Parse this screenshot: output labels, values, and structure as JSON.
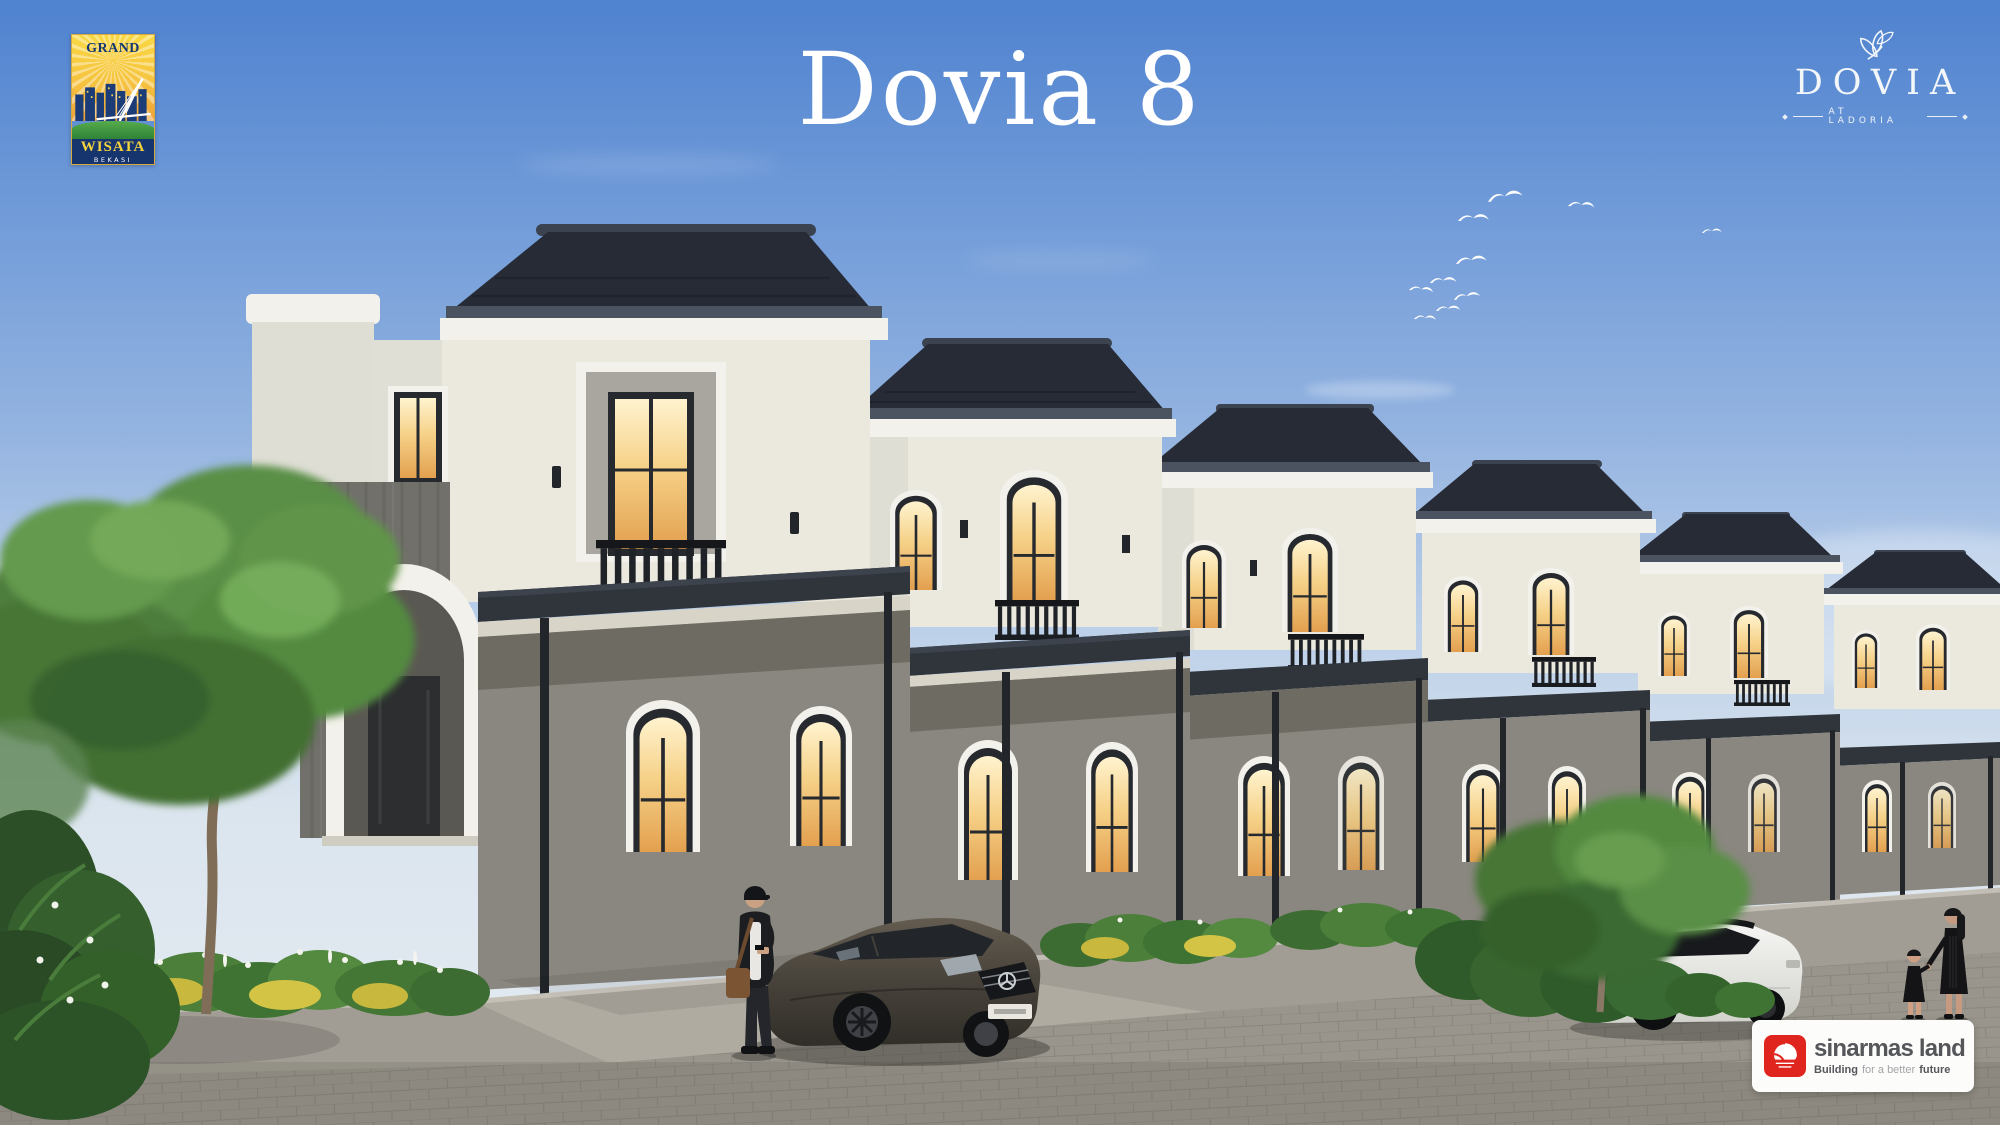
{
  "page": {
    "width": 2000,
    "height": 1125,
    "description": "Architectural launch visual of Dovia 8 two-storey houses at Ladoria, Grand Wisata Bekasi"
  },
  "grand_wisata_logo": {
    "top": "GRAND",
    "middle": "WISATA",
    "bottom": "BEKASI"
  },
  "title": {
    "text": "Dovia 8"
  },
  "dovia_logo": {
    "name": "DOVIA",
    "tagline": "AT LADORIA"
  },
  "sinarmas_logo": {
    "brand": "sinarmas land",
    "tagline_bold_start": "Building",
    "tagline_light": "for a better",
    "tagline_bold_end": "future"
  },
  "colors": {
    "sky_top": "#4f82cf",
    "sky_horizon": "#e4ebf1",
    "roof": "#262b36",
    "upper_wall": "#ebe8de",
    "ground_wall": "#89877f",
    "stone_accent": "#71706b",
    "white_trim": "#f3f1eb",
    "window_frame": "#26292e",
    "window_glow": "#f6d289",
    "canopy": "#30353c",
    "foliage": "#4e7d3c",
    "hedge_yellow": "#cdbc42",
    "pavement": "#99958c",
    "sinarmas_red": "#e0251f",
    "logo_navy": "#16356f",
    "logo_yellow": "#f6d33c",
    "logo_green": "#3f9c3a"
  }
}
